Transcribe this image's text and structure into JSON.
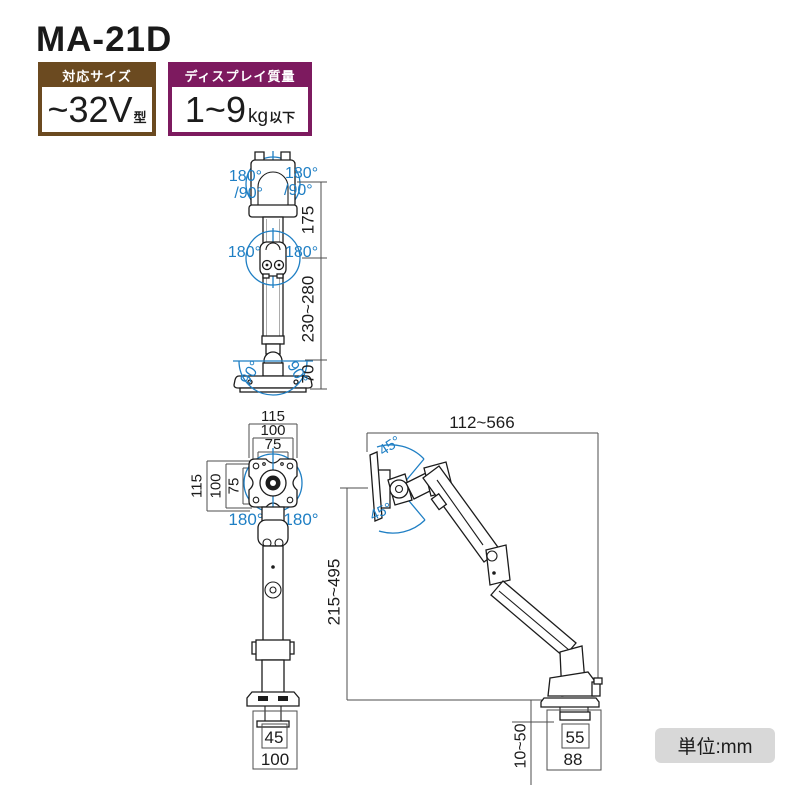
{
  "title": "MA-21D",
  "badge_size": {
    "header": "対応サイズ",
    "value": "~32V",
    "unit": "型"
  },
  "badge_weight": {
    "header": "ディスプレイ質量",
    "value": "1~9",
    "unit": "kg",
    "suffix": "以下"
  },
  "unit_note": "単位:mm",
  "colors": {
    "accent_blue": "#1f7fc4",
    "brown": "#6b4a20",
    "purple": "#7d1a5f",
    "line": "#1c1c1c",
    "dim_gray": "#4d4d4d",
    "note_bg": "#d8d8d8"
  },
  "front_view": {
    "swivel_top_left": "180°",
    "swivel_top_left_sub": "/90°",
    "swivel_top_right": "180°",
    "swivel_top_right_sub": "/90°",
    "swivel_mid_left": "180°",
    "swivel_mid_right": "180°",
    "tilt_base_left": "90°",
    "tilt_base_right": "90°",
    "dim_head": "175",
    "dim_pole": "230~280",
    "dim_base": "70"
  },
  "vesa_view": {
    "dim_top_outer": "115",
    "dim_top_mid": "100",
    "dim_top_inner": "75",
    "dim_left_outer": "115",
    "dim_left_mid": "100",
    "dim_left_inner": "75",
    "rot_left": "180°",
    "rot_right": "180°",
    "dim_base_inner": "45",
    "dim_base_outer": "100"
  },
  "side_view": {
    "dim_reach": "112~566",
    "tilt_up": "45°",
    "tilt_down": "45°",
    "dim_height": "215~495",
    "dim_desk_thickness": "10~50",
    "dim_clamp_inner": "55",
    "dim_clamp_outer": "88"
  }
}
